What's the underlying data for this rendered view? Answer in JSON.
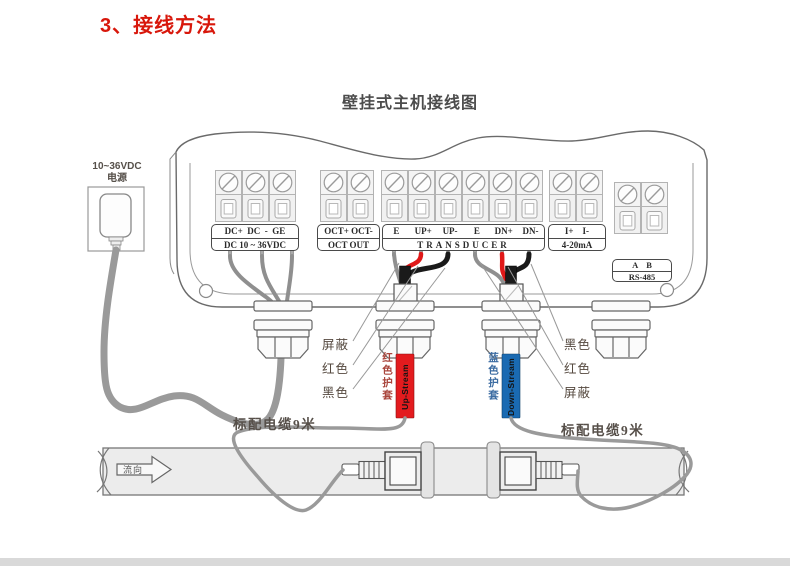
{
  "page": {
    "title": "3、接线方法",
    "subtitle": "壁挂式主机接线图"
  },
  "power": {
    "label_line1": "10~36VDC",
    "label_line2": "电源"
  },
  "terminal_groups": {
    "dc": {
      "row1": "DC+  DC  -  GE",
      "row2": "DC 10 ~ 36VDC"
    },
    "oct": {
      "row1": "OCT+ OCT-",
      "row2": "OCT OUT"
    },
    "transducer": {
      "pins": [
        "E",
        "UP+",
        "UP-",
        "E",
        "DN+",
        "DN-"
      ],
      "row2": "TRANSDUCER"
    },
    "current": {
      "row1": "I+    I-",
      "row2": "4-20mA"
    },
    "rs485": {
      "row1": "A    B",
      "row2": "RS-485"
    }
  },
  "callouts": {
    "left": [
      "屏蔽",
      "红色",
      "黑色"
    ],
    "right": [
      "黑色",
      "红色",
      "屏蔽"
    ]
  },
  "sleeves": {
    "up": {
      "label": "红色护套",
      "tag": "Up-Stream",
      "color": "#e31b1e",
      "label_color": "#a9453c"
    },
    "down": {
      "label": "蓝色护套",
      "tag": "Down-Stream",
      "color": "#1a6ab2",
      "label_color": "#3c6ca2"
    }
  },
  "cables": {
    "left_label": "标配电缆9米",
    "right_label": "标配电缆9米"
  },
  "pipe": {
    "flow_label": "流向"
  },
  "wire_colors": {
    "red": "#e01818",
    "black": "#1a1a1a",
    "shield": "#8f8f8f"
  }
}
